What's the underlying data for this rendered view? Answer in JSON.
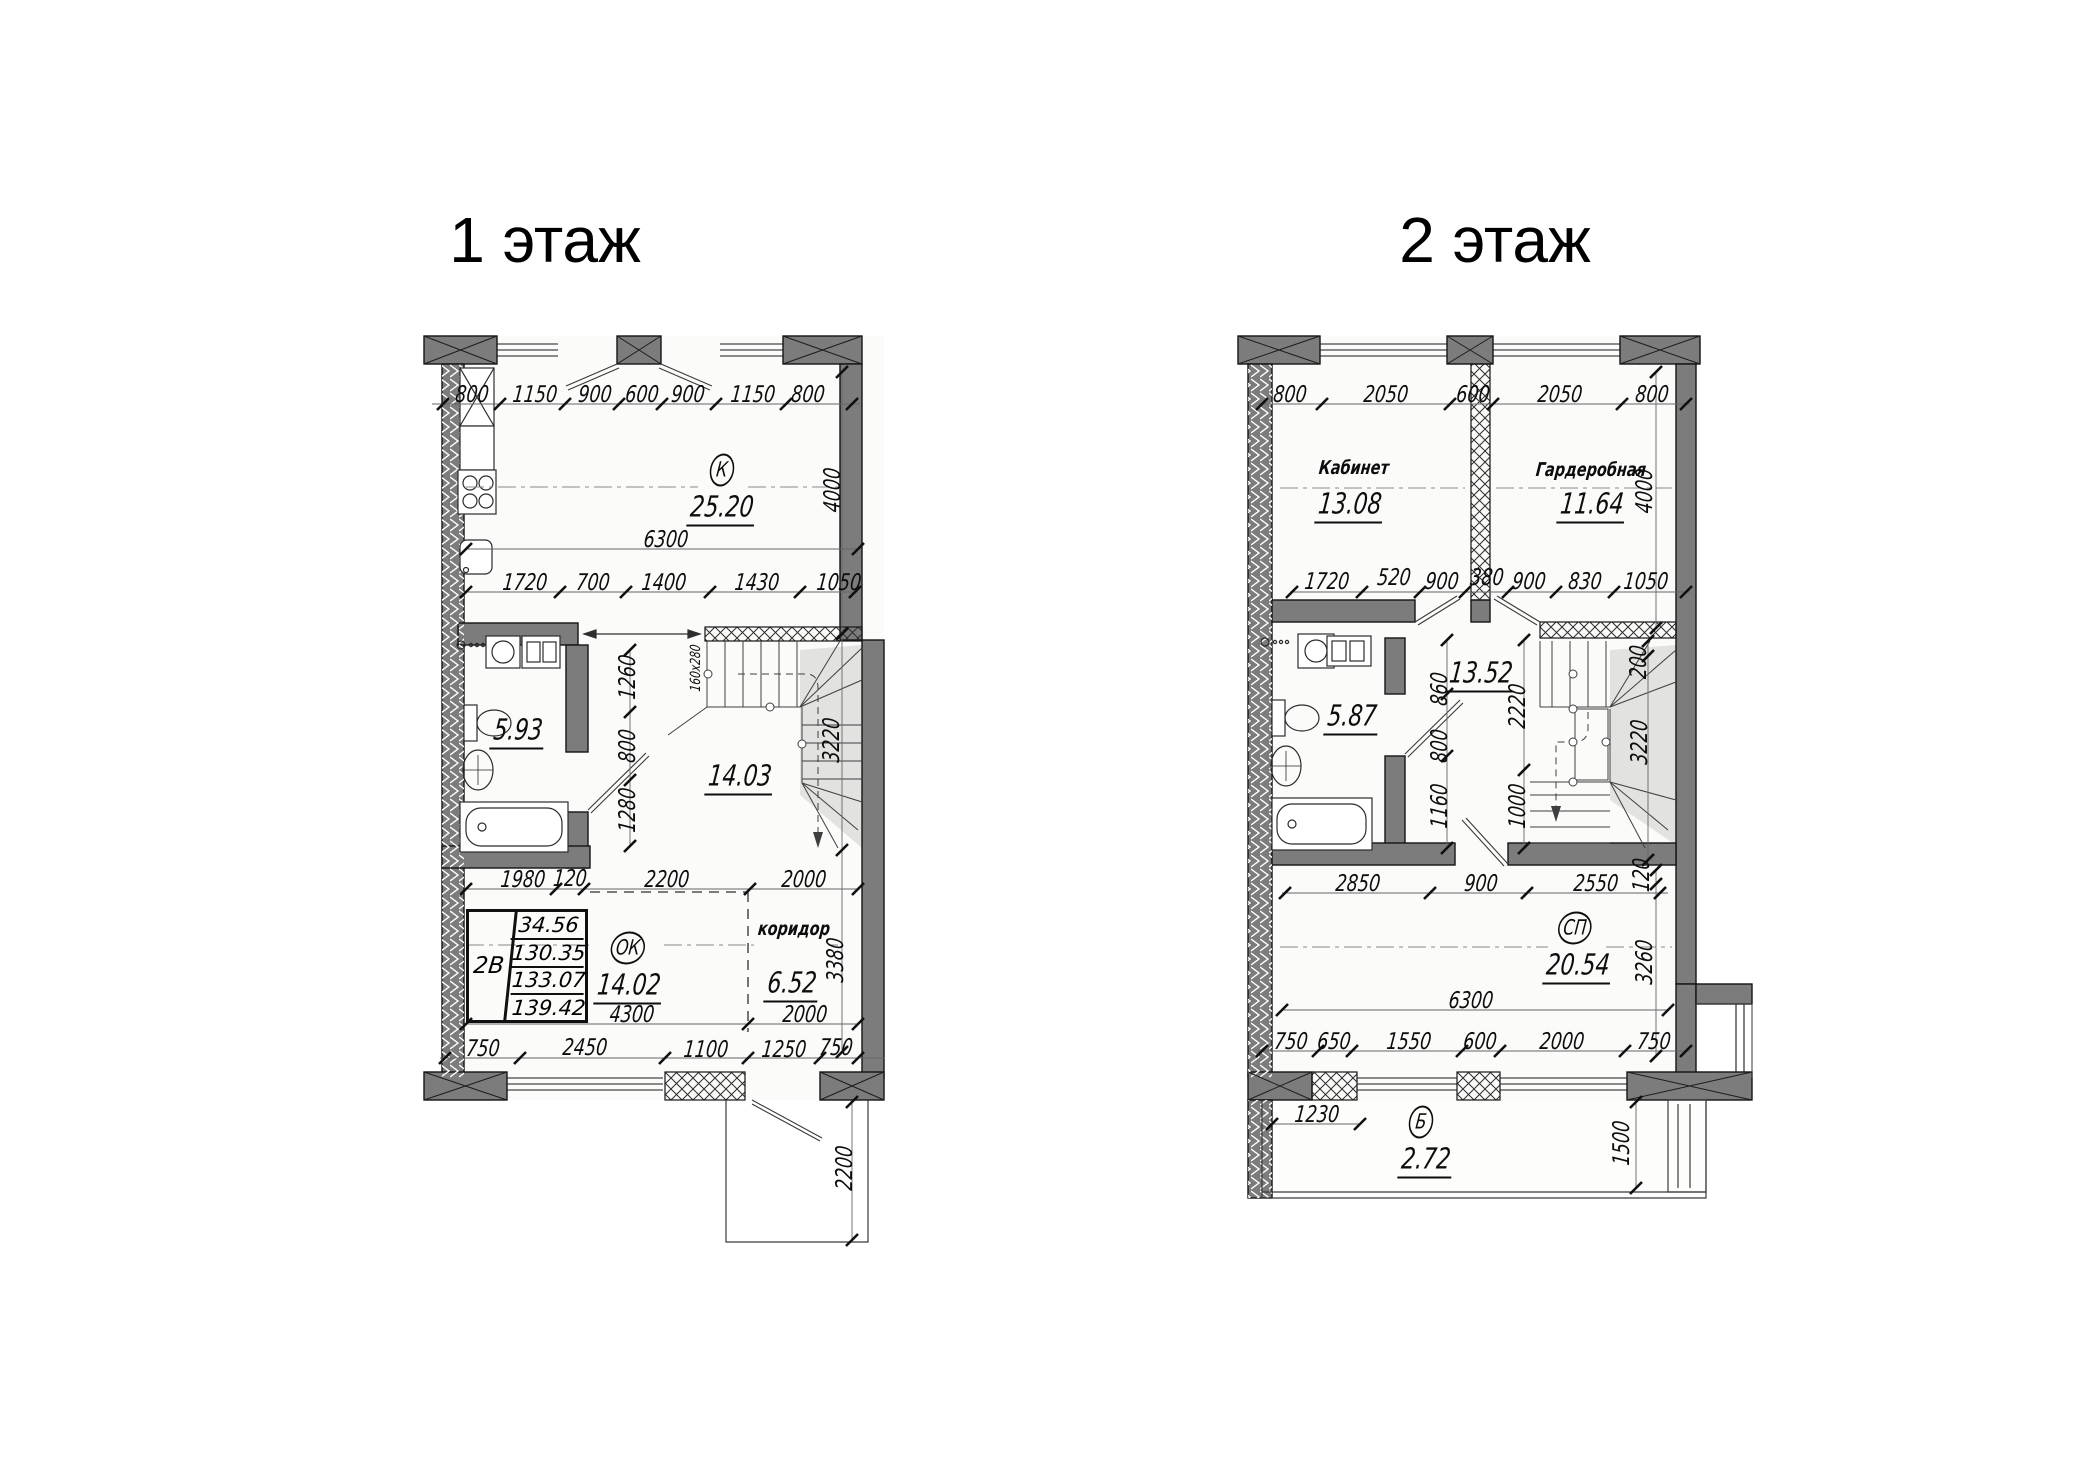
{
  "drawing": {
    "background": "#ffffff",
    "ink": "#111111",
    "wall_fill": "#7c7c7c"
  },
  "floors": [
    {
      "id": "floor-1",
      "title": "1 этаж",
      "labels": [
        {
          "t": "800",
          "x": 472,
          "y": 395,
          "k": "dim"
        },
        {
          "t": "1150",
          "x": 535,
          "y": 395,
          "k": "dim"
        },
        {
          "t": "900",
          "x": 595,
          "y": 395,
          "k": "dim"
        },
        {
          "t": "600",
          "x": 642,
          "y": 395,
          "k": "dim"
        },
        {
          "t": "900",
          "x": 688,
          "y": 395,
          "k": "dim"
        },
        {
          "t": "1150",
          "x": 753,
          "y": 395,
          "k": "dim"
        },
        {
          "t": "800",
          "x": 808,
          "y": 395,
          "k": "dim"
        },
        {
          "t": "К",
          "x": 722,
          "y": 470,
          "k": "tag"
        },
        {
          "t": "25.20",
          "x": 722,
          "y": 508,
          "k": "area"
        },
        {
          "t": "6300",
          "x": 666,
          "y": 540,
          "k": "dim"
        },
        {
          "t": "4000",
          "x": 833,
          "y": 490,
          "k": "dimv"
        },
        {
          "t": "1720",
          "x": 525,
          "y": 583,
          "k": "dim"
        },
        {
          "t": "700",
          "x": 593,
          "y": 583,
          "k": "dim"
        },
        {
          "t": "1400",
          "x": 664,
          "y": 583,
          "k": "dim"
        },
        {
          "t": "1430",
          "x": 757,
          "y": 583,
          "k": "dim"
        },
        {
          "t": "1050",
          "x": 839,
          "y": 583,
          "k": "dim"
        },
        {
          "t": "1260",
          "x": 628,
          "y": 677,
          "k": "dimv"
        },
        {
          "t": "800",
          "x": 628,
          "y": 746,
          "k": "dimv"
        },
        {
          "t": "1280",
          "x": 628,
          "y": 810,
          "k": "dimv"
        },
        {
          "t": "160x280",
          "x": 696,
          "y": 668,
          "k": "notev"
        },
        {
          "t": "3220",
          "x": 832,
          "y": 740,
          "k": "dimv"
        },
        {
          "t": "5.93",
          "x": 518,
          "y": 731,
          "k": "area"
        },
        {
          "t": "14.03",
          "x": 740,
          "y": 777,
          "k": "area"
        },
        {
          "t": "1980",
          "x": 523,
          "y": 880,
          "k": "dim"
        },
        {
          "t": "120",
          "x": 570,
          "y": 879,
          "k": "dim"
        },
        {
          "t": "2200",
          "x": 667,
          "y": 880,
          "k": "dim"
        },
        {
          "t": "2000",
          "x": 804,
          "y": 880,
          "k": "dim"
        },
        {
          "t": "ОК",
          "x": 628,
          "y": 948,
          "k": "tag"
        },
        {
          "t": "14.02",
          "x": 629,
          "y": 986,
          "k": "area"
        },
        {
          "t": "коридор",
          "x": 794,
          "y": 929,
          "k": "name"
        },
        {
          "t": "6.52",
          "x": 792,
          "y": 984,
          "k": "area"
        },
        {
          "t": "3380",
          "x": 836,
          "y": 960,
          "k": "dimv"
        },
        {
          "t": "4300",
          "x": 632,
          "y": 1015,
          "k": "dim"
        },
        {
          "t": "2000",
          "x": 805,
          "y": 1015,
          "k": "dim"
        },
        {
          "t": "750",
          "x": 483,
          "y": 1049,
          "k": "dim"
        },
        {
          "t": "2450",
          "x": 585,
          "y": 1048,
          "k": "dim"
        },
        {
          "t": "1100",
          "x": 706,
          "y": 1050,
          "k": "dim"
        },
        {
          "t": "1250",
          "x": 784,
          "y": 1050,
          "k": "dim"
        },
        {
          "t": "750",
          "x": 836,
          "y": 1048,
          "k": "dim"
        },
        {
          "t": "2200",
          "x": 845,
          "y": 1168,
          "k": "dimv"
        }
      ]
    },
    {
      "id": "floor-2",
      "title": "2 этаж",
      "labels": [
        {
          "t": "800",
          "x": 1290,
          "y": 395,
          "k": "dim"
        },
        {
          "t": "2050",
          "x": 1386,
          "y": 395,
          "k": "dim"
        },
        {
          "t": "600",
          "x": 1473,
          "y": 395,
          "k": "dim"
        },
        {
          "t": "2050",
          "x": 1560,
          "y": 395,
          "k": "dim"
        },
        {
          "t": "800",
          "x": 1652,
          "y": 395,
          "k": "dim"
        },
        {
          "t": "Кабинет",
          "x": 1354,
          "y": 468,
          "k": "name"
        },
        {
          "t": "13.08",
          "x": 1350,
          "y": 505,
          "k": "area"
        },
        {
          "t": "Гардеробная",
          "x": 1591,
          "y": 470,
          "k": "name"
        },
        {
          "t": "11.64",
          "x": 1592,
          "y": 505,
          "k": "area"
        },
        {
          "t": "4000",
          "x": 1645,
          "y": 491,
          "k": "dimv"
        },
        {
          "t": "1720",
          "x": 1327,
          "y": 582,
          "k": "dim"
        },
        {
          "t": "520",
          "x": 1394,
          "y": 578,
          "k": "dim"
        },
        {
          "t": "900",
          "x": 1442,
          "y": 582,
          "k": "dim"
        },
        {
          "t": "380",
          "x": 1487,
          "y": 578,
          "k": "dim"
        },
        {
          "t": "900",
          "x": 1529,
          "y": 582,
          "k": "dim"
        },
        {
          "t": "830",
          "x": 1585,
          "y": 582,
          "k": "dim"
        },
        {
          "t": "1050",
          "x": 1646,
          "y": 582,
          "k": "dim"
        },
        {
          "t": "5.87",
          "x": 1352,
          "y": 717,
          "k": "area"
        },
        {
          "t": "13.52",
          "x": 1481,
          "y": 674,
          "k": "area"
        },
        {
          "t": "860",
          "x": 1440,
          "y": 689,
          "k": "dimv"
        },
        {
          "t": "800",
          "x": 1440,
          "y": 746,
          "k": "dimv"
        },
        {
          "t": "1160",
          "x": 1440,
          "y": 806,
          "k": "dimv"
        },
        {
          "t": "2220",
          "x": 1518,
          "y": 706,
          "k": "dimv"
        },
        {
          "t": "1000",
          "x": 1518,
          "y": 806,
          "k": "dimv"
        },
        {
          "t": "200",
          "x": 1639,
          "y": 662,
          "k": "dimv"
        },
        {
          "t": "3220",
          "x": 1640,
          "y": 742,
          "k": "dimv"
        },
        {
          "t": "2850",
          "x": 1358,
          "y": 884,
          "k": "dim"
        },
        {
          "t": "900",
          "x": 1481,
          "y": 884,
          "k": "dim"
        },
        {
          "t": "2550",
          "x": 1596,
          "y": 884,
          "k": "dim"
        },
        {
          "t": "120",
          "x": 1642,
          "y": 875,
          "k": "dimv"
        },
        {
          "t": "СП",
          "x": 1575,
          "y": 928,
          "k": "tag"
        },
        {
          "t": "20.54",
          "x": 1578,
          "y": 966,
          "k": "area"
        },
        {
          "t": "3260",
          "x": 1645,
          "y": 962,
          "k": "dimv"
        },
        {
          "t": "6300",
          "x": 1471,
          "y": 1001,
          "k": "dim"
        },
        {
          "t": "750",
          "x": 1291,
          "y": 1042,
          "k": "dim"
        },
        {
          "t": "650",
          "x": 1334,
          "y": 1042,
          "k": "dim"
        },
        {
          "t": "1550",
          "x": 1409,
          "y": 1042,
          "k": "dim"
        },
        {
          "t": "600",
          "x": 1480,
          "y": 1042,
          "k": "dim"
        },
        {
          "t": "2000",
          "x": 1562,
          "y": 1042,
          "k": "dim"
        },
        {
          "t": "750",
          "x": 1654,
          "y": 1042,
          "k": "dim"
        },
        {
          "t": "1230",
          "x": 1317,
          "y": 1115,
          "k": "dim"
        },
        {
          "t": "Б",
          "x": 1421,
          "y": 1122,
          "k": "tag"
        },
        {
          "t": "2.72",
          "x": 1426,
          "y": 1160,
          "k": "area"
        },
        {
          "t": "1500",
          "x": 1622,
          "y": 1143,
          "k": "dimv"
        }
      ]
    }
  ],
  "info_table": {
    "type": "2В",
    "values": [
      "34.56",
      "130.35",
      "133.07",
      "139.42"
    ]
  }
}
